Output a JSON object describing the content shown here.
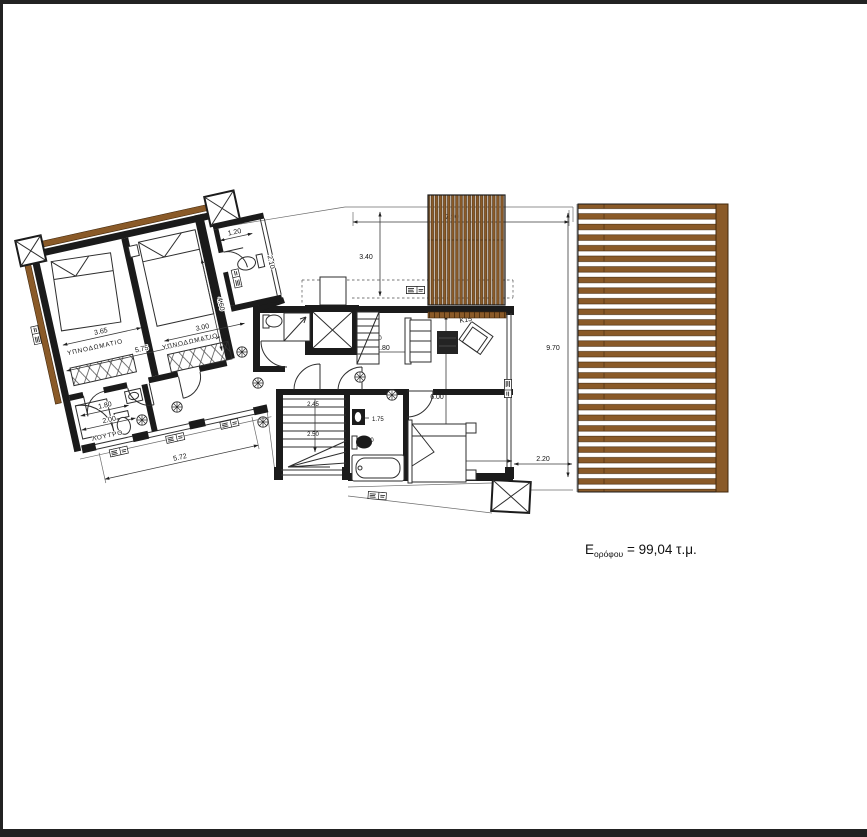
{
  "page": {
    "area_label_prefix": "E",
    "area_label_sub": "ορόφου",
    "area_label_rest": " = 99,04 τ.μ."
  },
  "rooms": {
    "bedroom1": "ΥΠΝΟΔΩΜΑΤΙΟ",
    "bedroom2": "ΥΠΝΟΔΩΜΑΤΙΟ",
    "bathroom": "ΛΟΥΤΡΟ",
    "armchair_tag": "K15"
  },
  "dims": {
    "wing_wc_width": "1.20",
    "wing_wc_depth": "2.10",
    "bed1_width": "3.65",
    "bed2_width": "3.00",
    "wing_width": "5.75",
    "bed2_depth": "4.60",
    "wing_bath_width": "1.80",
    "wing_bath_depth": "2.00",
    "wing_total": "5.72",
    "stair_a": "2.45",
    "stair_b": "2.50",
    "ladder": "1.70",
    "hall_width": "1.80",
    "terrace_top_depth": "3.40",
    "terrace_top_width": "7.90",
    "living_depth": "6.00",
    "terrace_right_depth": "9.70",
    "bath_a": "1.75",
    "bath_b": "3.00",
    "bed_main_width": "3.40",
    "terrace_right_width": "2.20"
  },
  "colors": {
    "wood": "#8a5a28",
    "wall": "#1b1b1b",
    "line": "#3c3c3c",
    "paper": "#ffffff"
  }
}
